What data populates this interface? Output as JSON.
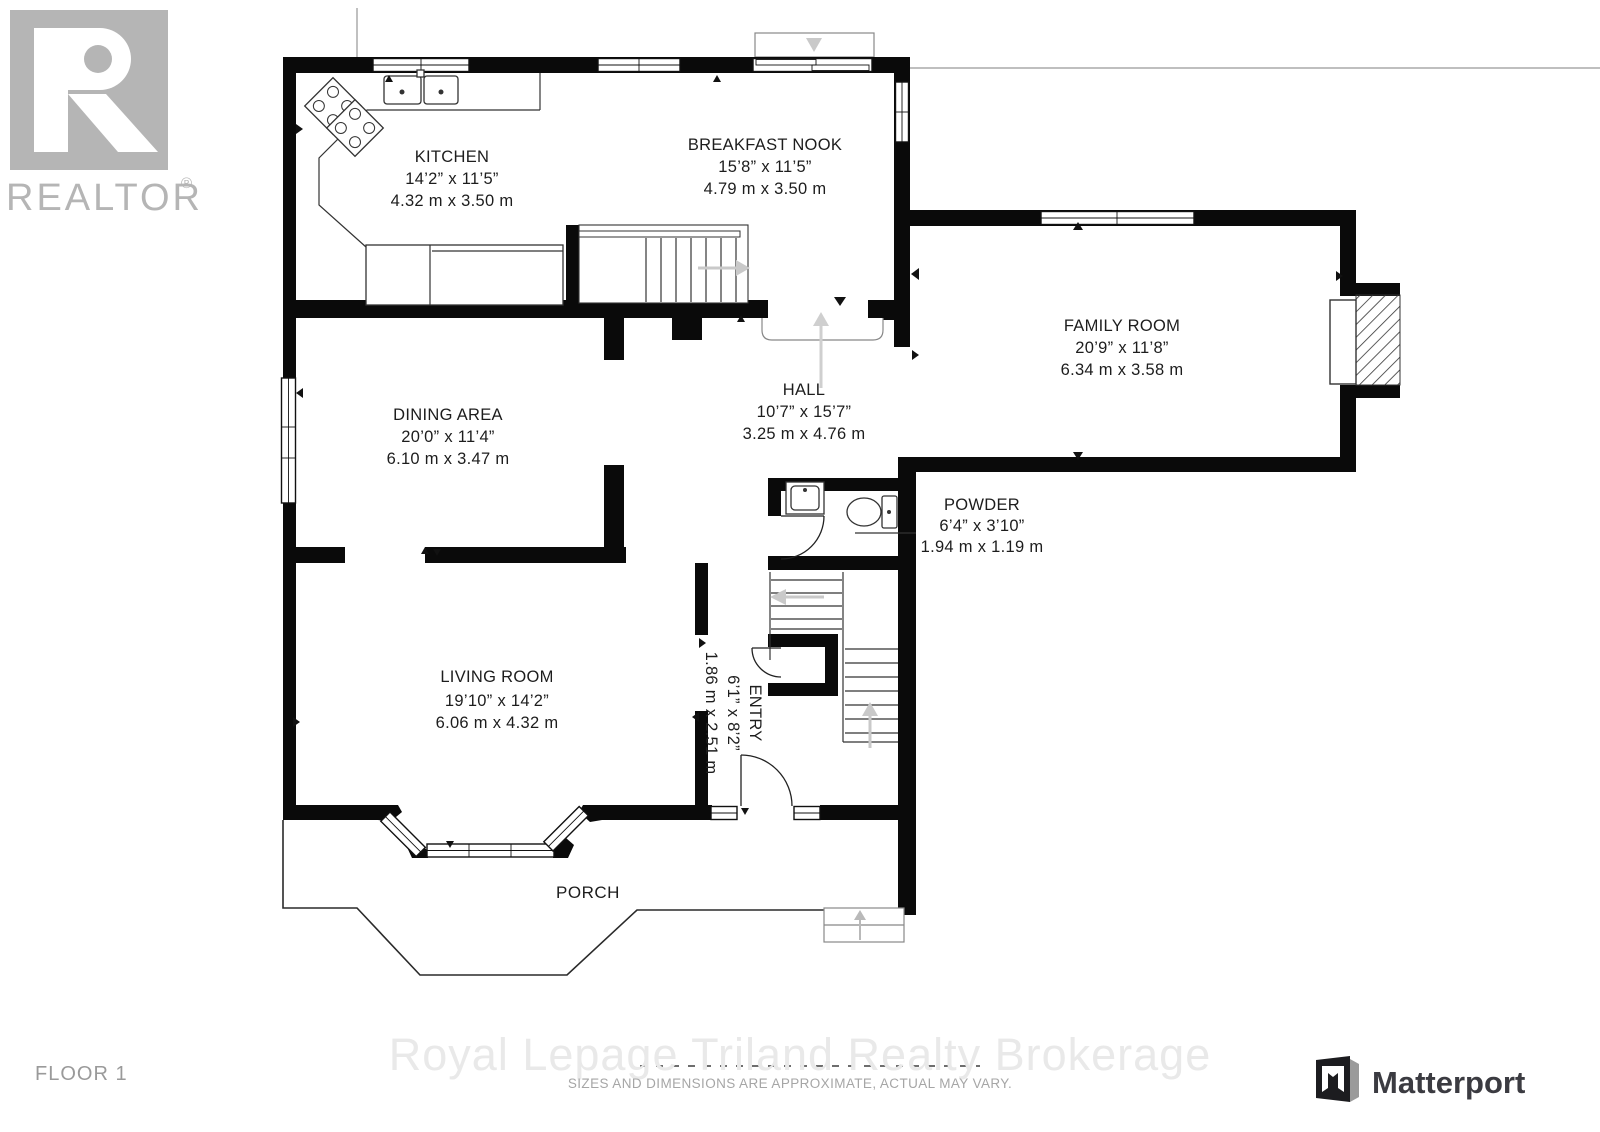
{
  "branding": {
    "realtor_logo_text": "REALTOR",
    "realtor_reg": "®",
    "matterport_text": "Matterport",
    "floor_label": "FLOOR 1"
  },
  "watermark": {
    "brokerage": "Royal Lepage Triland Realty Brokerage",
    "disclaimer": "SIZES AND DIMENSIONS ARE APPROXIMATE, ACTUAL MAY VARY."
  },
  "rooms": [
    {
      "name": "KITCHEN",
      "imperial": "14’2” x 11’5”",
      "metric": "4.32 m x 3.50 m"
    },
    {
      "name": "BREAKFAST NOOK",
      "imperial": "15’8” x 11’5”",
      "metric": "4.79 m x 3.50 m"
    },
    {
      "name": "FAMILY ROOM",
      "imperial": "20’9” x 11’8”",
      "metric": "6.34 m x 3.58 m"
    },
    {
      "name": "DINING AREA",
      "imperial": "20’0” x 11’4”",
      "metric": "6.10 m x 3.47 m"
    },
    {
      "name": "HALL",
      "imperial": "10’7” x 15’7”",
      "metric": "3.25 m x 4.76 m"
    },
    {
      "name": "POWDER",
      "imperial": "6’4” x 3’10”",
      "metric": "1.94 m x 1.19 m"
    },
    {
      "name": "LIVING ROOM",
      "imperial": "19’10” x 14’2”",
      "metric": "6.06 m x 4.32 m"
    },
    {
      "name": "ENTRY",
      "imperial": "6’1” x 8’2”",
      "metric": "1.86 m x 2.51 m"
    },
    {
      "name": "PORCH",
      "imperial": "",
      "metric": ""
    }
  ],
  "icons": {
    "stair-up-arrow": "▲",
    "stair-down-arrow": "◄",
    "step-down-arrow": "▼",
    "matterport-mark": "folded-m"
  },
  "colors": {
    "wall": "#0a0a0a",
    "stair_arrow_gray": "#c9c9c9",
    "watermark_gray": "#e9e9e9",
    "realtor_gray": "#b5b5b5",
    "matterport_dark": "#3b3b41",
    "disclaimer_gray": "#a6a6a6",
    "floor_label_gray": "#9a9a9a"
  }
}
